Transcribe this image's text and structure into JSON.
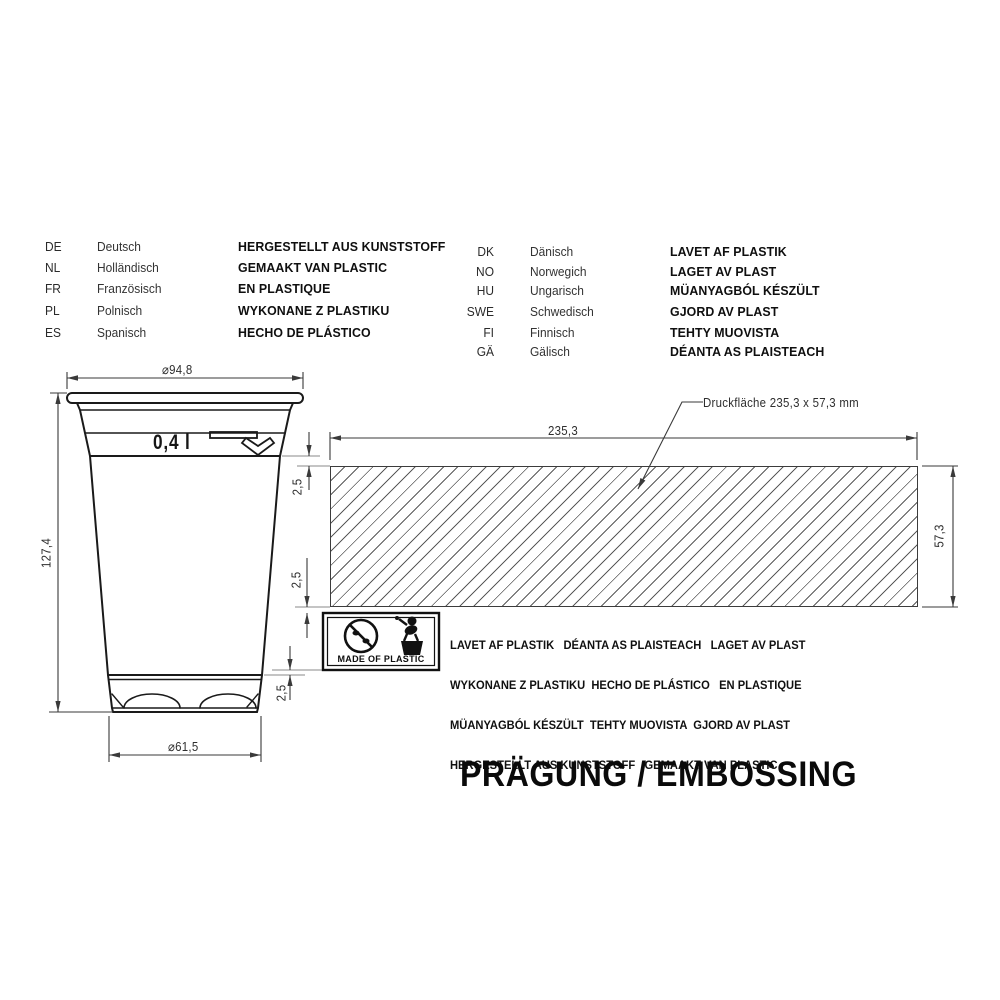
{
  "language_table": {
    "left": [
      {
        "code": "DE",
        "language": "Deutsch",
        "text": "HERGESTELLT AUS KUNSTSTOFF"
      },
      {
        "code": "NL",
        "language": "Holländisch",
        "text": "GEMAAKT VAN PLASTIC"
      },
      {
        "code": "FR",
        "language": "Französisch",
        "text": "EN PLASTIQUE"
      },
      {
        "code": "PL",
        "language": "Polnisch",
        "text": "WYKONANE Z PLASTIKU"
      },
      {
        "code": "ES",
        "language": "Spanisch",
        "text": "HECHO DE PLÁSTICO"
      }
    ],
    "right": [
      {
        "code": "DK",
        "language": "Dänisch",
        "text": "LAVET AF PLASTIK"
      },
      {
        "code": "NO",
        "language": "Norwegich",
        "text": "LAGET AV PLAST"
      },
      {
        "code": "HU",
        "language": "Ungarisch",
        "text": "MÜANYAGBÓL KÉSZÜLT"
      },
      {
        "code": "SWE",
        "language": "Schwedisch",
        "text": "GJORD AV PLAST"
      },
      {
        "code": "FI",
        "language": "Finnisch",
        "text": "TEHTY MUOVISTA"
      },
      {
        "code": "GÄ",
        "language": "Gälisch",
        "text": "DÉANTA AS PLAISTEACH"
      }
    ]
  },
  "drawing": {
    "volume_label": "0,4 l",
    "print_area_label": "Druckfläche 235,3 x 57,3 mm",
    "dimensions": {
      "top_diameter": "⌀94,8",
      "height": "127,4",
      "bottom_diameter": "⌀61,5",
      "print_width": "235,3",
      "print_height": "57,3",
      "offset_top": "2,5",
      "offset_middle": "2,5",
      "offset_bottom": "2,5"
    }
  },
  "embossing_block": {
    "lines": [
      "LAVET AF PLASTIK   DÉANTA AS PLAISTEACH   LAGET AV PLAST",
      "WYKONANE Z PLASTIKU  HECHO DE PLÁSTICO   EN PLASTIQUE",
      "MÜANYAGBÓL KÉSZÜLT  TEHTY MUOVISTA  GJORD AV PLAST",
      "HERGESTELLT AUS KUNSTSTOFF   GEMAAKT VAN PLASTIC"
    ],
    "badge_label": "MADE OF PLASTIC"
  },
  "title": "PRÄGUNG / EMBOSSING",
  "colors": {
    "line": "#1a1a1a",
    "dim_line": "#3a3a3a",
    "hatch": "#5a5a5a",
    "background": "#ffffff"
  }
}
